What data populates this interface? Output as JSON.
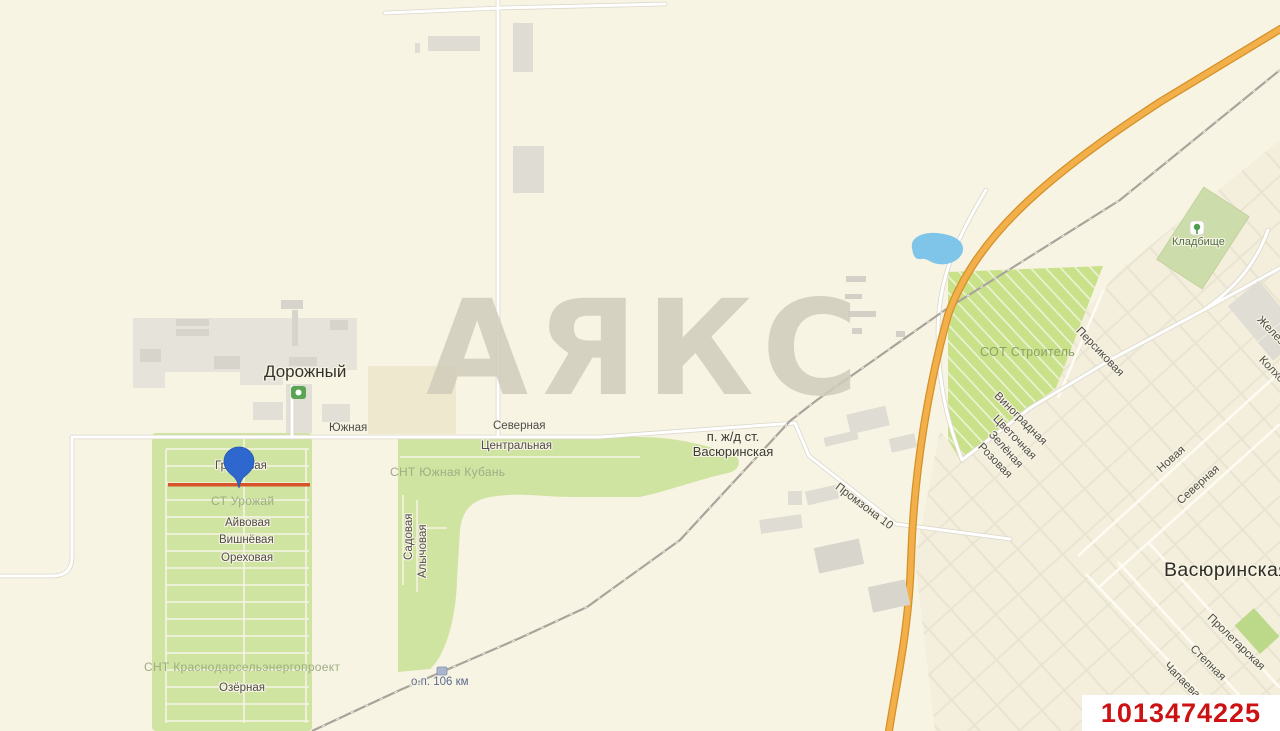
{
  "map": {
    "watermark_text": "АЯКС",
    "listing_id": "1013474225",
    "places": {
      "dorozhny": "Дорожный",
      "station_line1": "п. ж/д ст.",
      "station_line2": "Васюринская",
      "vasyurinskaya": "Васюринская",
      "cemetery": "Кладбище",
      "rail_stop": "о.п. 106 км"
    },
    "areas": {
      "snt_yuzhnaya_kuban": "СНТ Южная Кубань",
      "st_urozhay": "СТ Урожай",
      "snt_krasnodarselenergoproekt": "СНТ Краснодарсельэнергопроект",
      "sot_stroitel": "СОТ Строитель"
    },
    "streets": {
      "yuzhnaya": "Южная",
      "severnaya": "Северная",
      "tsentralnaya": "Центральная",
      "grushevaya": "Грушёвая",
      "ayvovaya": "Айвовая",
      "vishnyovaya": "Вишнёвая",
      "orekhovaya": "Ореховая",
      "ozyornaya": "Озёрная",
      "sadovaya": "Садовая",
      "alychovaya": "Алычовая",
      "promzona_10": "Промзона 10",
      "persikovaya": "Персиковая",
      "vinogradnaya": "Виноградная",
      "tsvetochnaya": "Цветочная",
      "zelyonaya": "Зелёная",
      "rozovaya": "Розовая",
      "novaya": "Новая",
      "severnaya_vostok": "Северная",
      "proletarskaya": "Пролетарская",
      "stepnaya": "Степная",
      "chapaeva": "Чапаева",
      "zheleznodorozhnaya": "Железнодорожная",
      "kolkhoznaya": "Колхозная"
    },
    "colors": {
      "background": "#f8f4e4",
      "green_area": "#cfe4a1",
      "green_bright": "#c9e189",
      "cemetery_green": "#cddcab",
      "water": "#7fc4e9",
      "highway_orange": "#f3b04a",
      "railway_gray": "#a8a49b",
      "pin_blue": "#2e68cf",
      "highlight_line": "#d7542a",
      "listing_id_red": "#cc1212"
    }
  }
}
